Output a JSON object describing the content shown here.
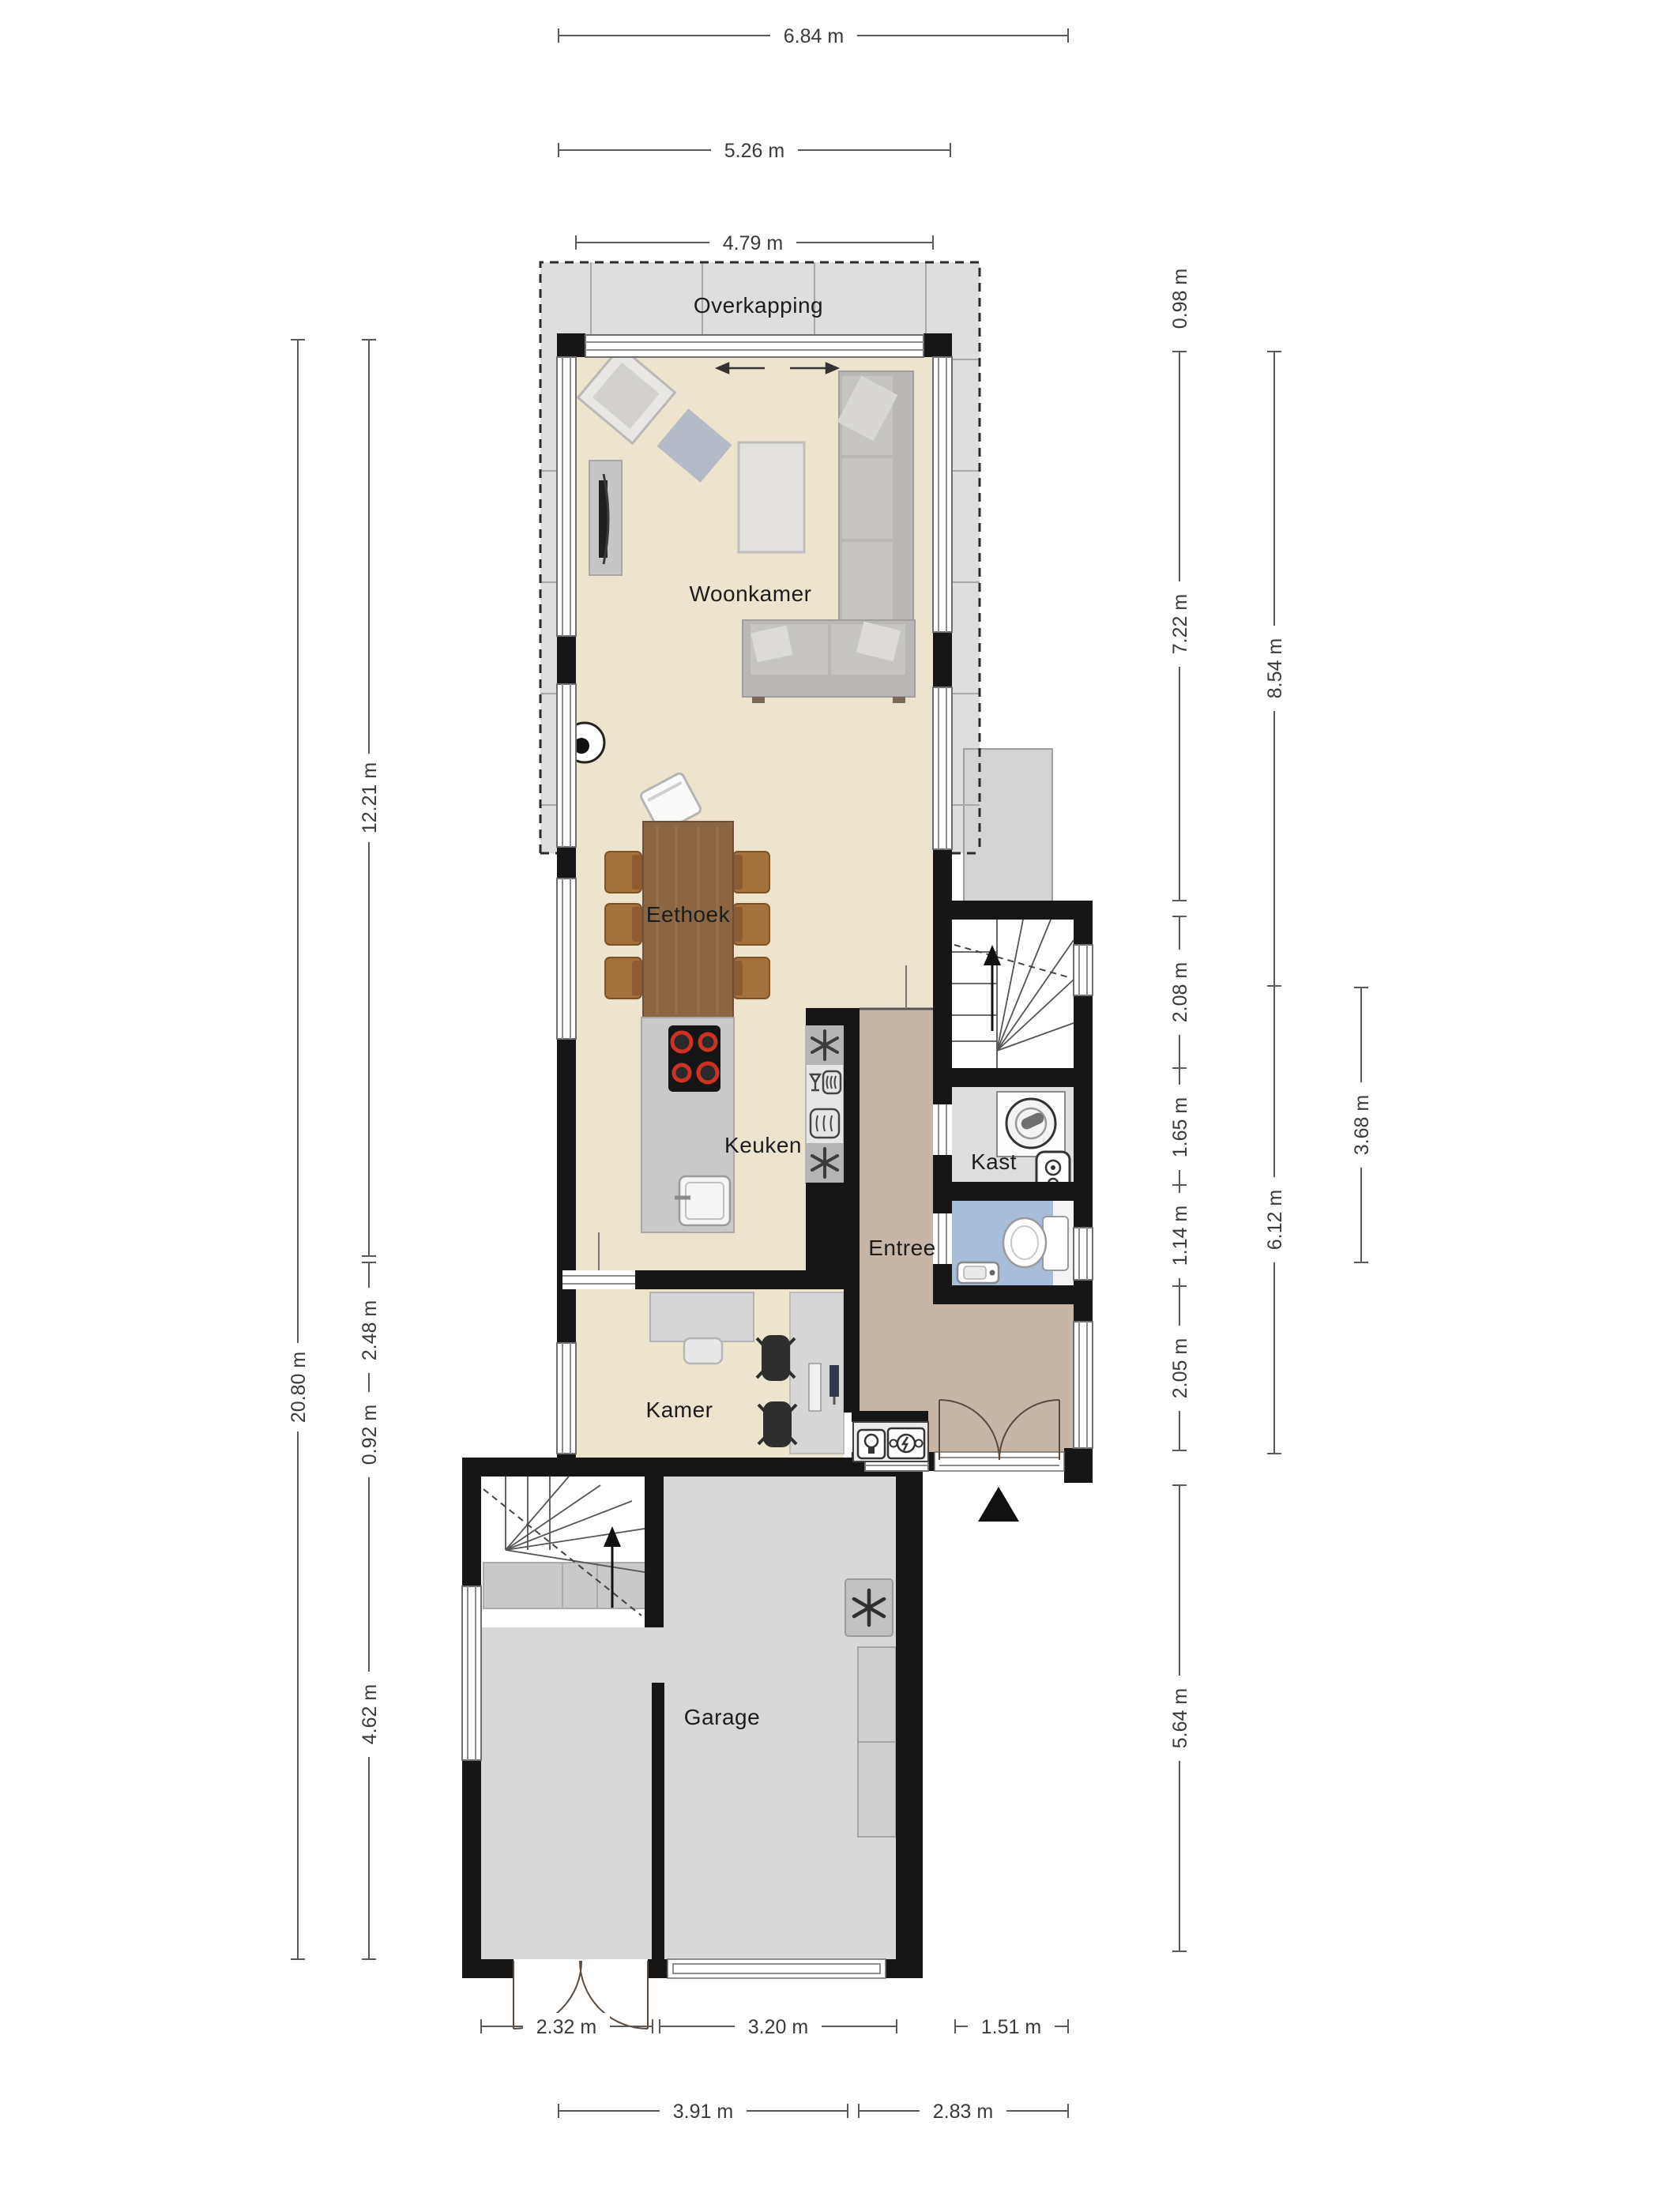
{
  "floorplan": {
    "title": "Begane grond plattegrond (ground floor plan)",
    "rooms": {
      "overkapping": "Overkapping",
      "woonkamer": "Woonkamer",
      "eethoek": "Eethoek",
      "keuken": "Keuken",
      "kast": "Kast",
      "entree": "Entree",
      "kamer": "Kamer",
      "garage": "Garage"
    },
    "dims": {
      "t1": "6.84 m",
      "t2": "5.26 m",
      "t3": "4.79 m",
      "l1": "20.80 m",
      "l2": "12.21 m",
      "l3": "2.48 m",
      "l4": "0.92 m",
      "l5": "4.62 m",
      "r1": "0.98 m",
      "r2": "7.22 m",
      "r3": "8.54 m",
      "r4": "2.08 m",
      "r5": "1.65 m",
      "r6": "1.14 m",
      "r7": "2.05 m",
      "r8": "6.12 m",
      "r9": "3.68 m",
      "r10": "5.64 m",
      "b1": "2.32 m",
      "b2": "3.20 m",
      "b3": "1.51 m",
      "b4": "3.91 m",
      "b5": "2.83 m"
    },
    "icons": {
      "north_arrow": "north-arrow",
      "snowflake_fridge": "snowflake-icon",
      "snowflake_freezer": "snowflake-icon",
      "dishwasher": "dishwasher-icon",
      "oven": "oven-icon",
      "washing_machine": "washing-machine-icon",
      "boiler": "boiler-icon",
      "toilet": "toilet-icon",
      "sink": "sink-icon",
      "cooktop": "cooktop-icon",
      "lamp": "lamp-icon",
      "fusebox": "fusebox-icon"
    },
    "colors": {
      "floor_living": "#ece4cd",
      "floor_entree": "#c7b5a6",
      "floor_toilet": "#a7bdd9",
      "floor_kast": "#dedede",
      "floor_garage": "#d8d8d8",
      "canopy": "#dedede",
      "wall": "#161616",
      "burner_red": "#cc3322",
      "wood": "#8a6645"
    }
  }
}
